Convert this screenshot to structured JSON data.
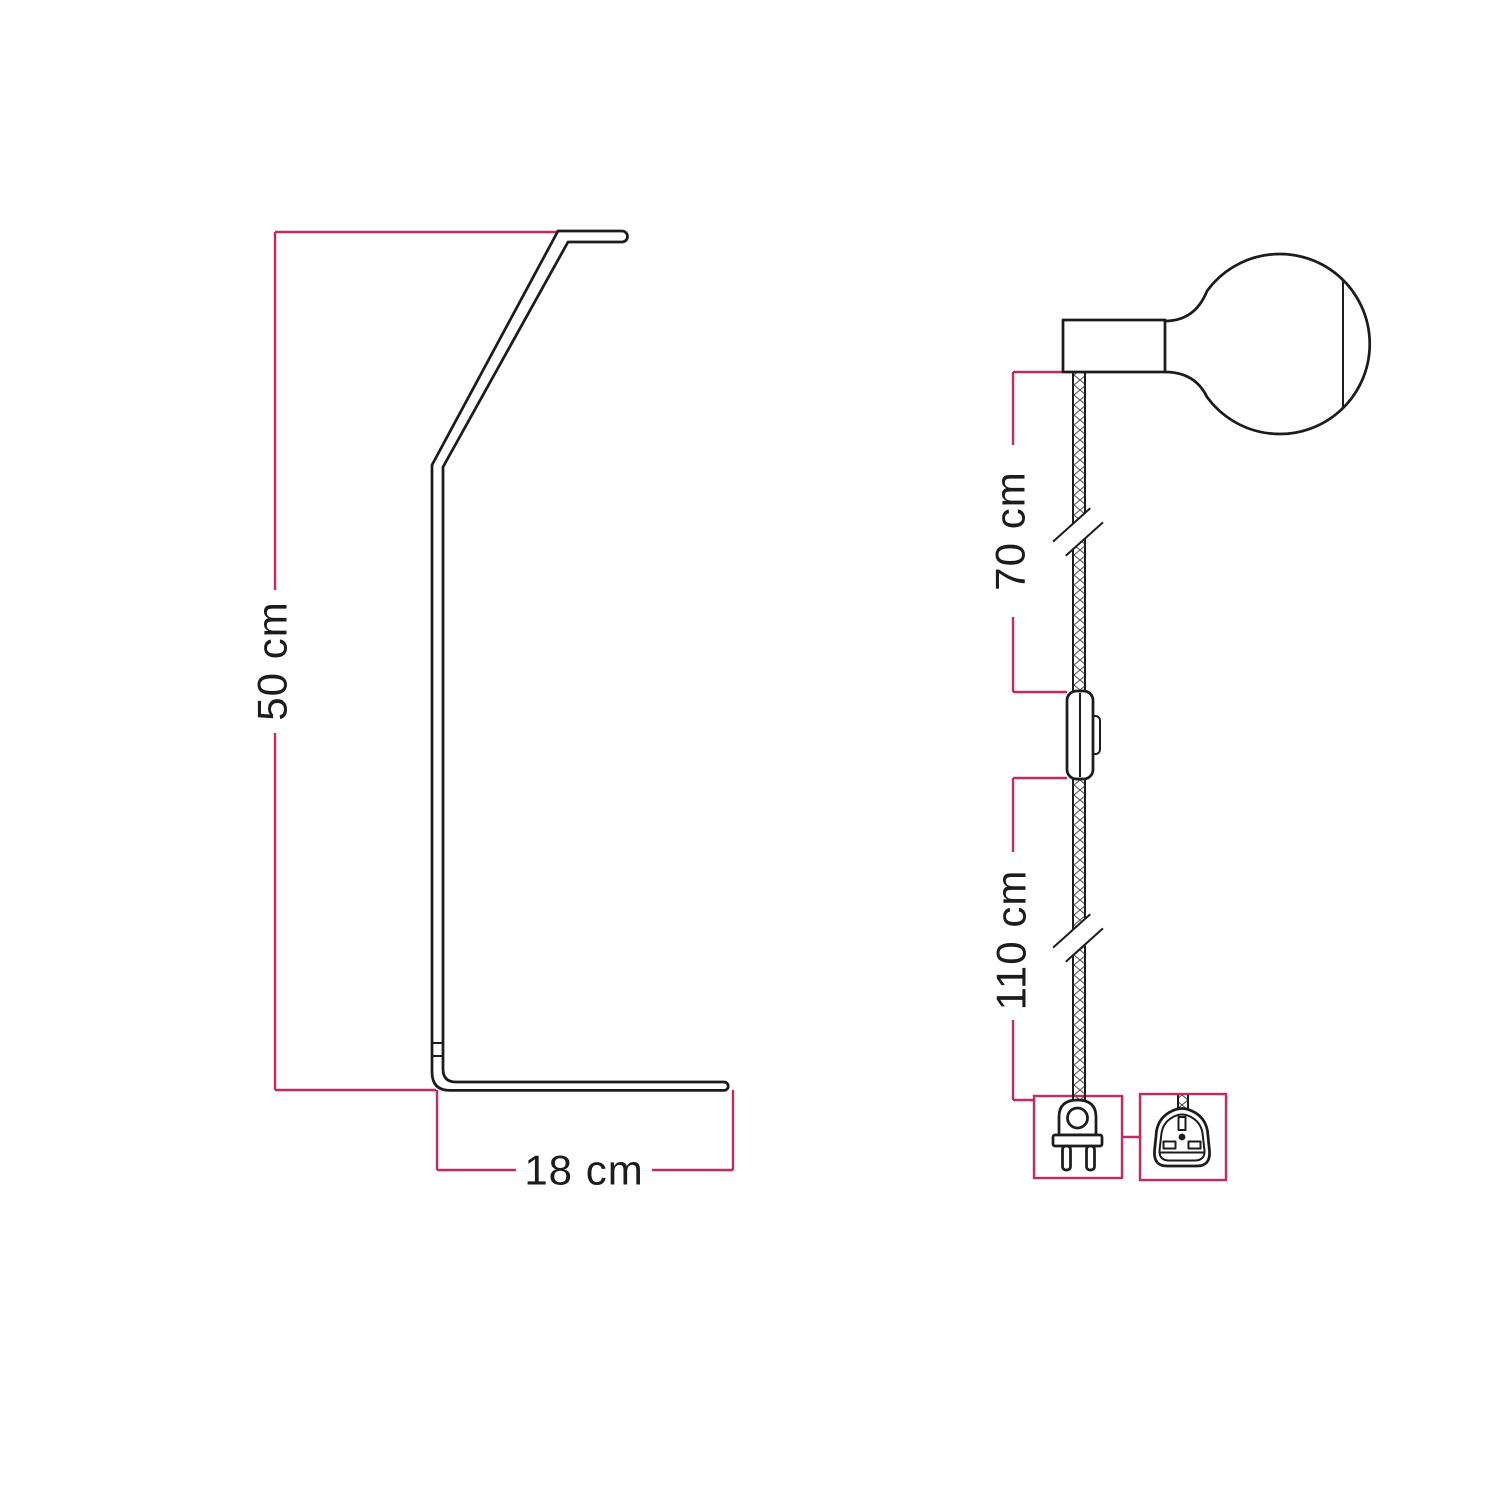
{
  "colors": {
    "background": "#ffffff",
    "drawing_stroke": "#1c1c1c",
    "dimension_accent": "#c52a5c"
  },
  "stand_view": {
    "height_dimension": "50 cm",
    "base_dimension": "18 cm"
  },
  "lamp_view": {
    "upper_cable_dimension": "70 cm",
    "lower_cable_dimension": "110 cm"
  }
}
